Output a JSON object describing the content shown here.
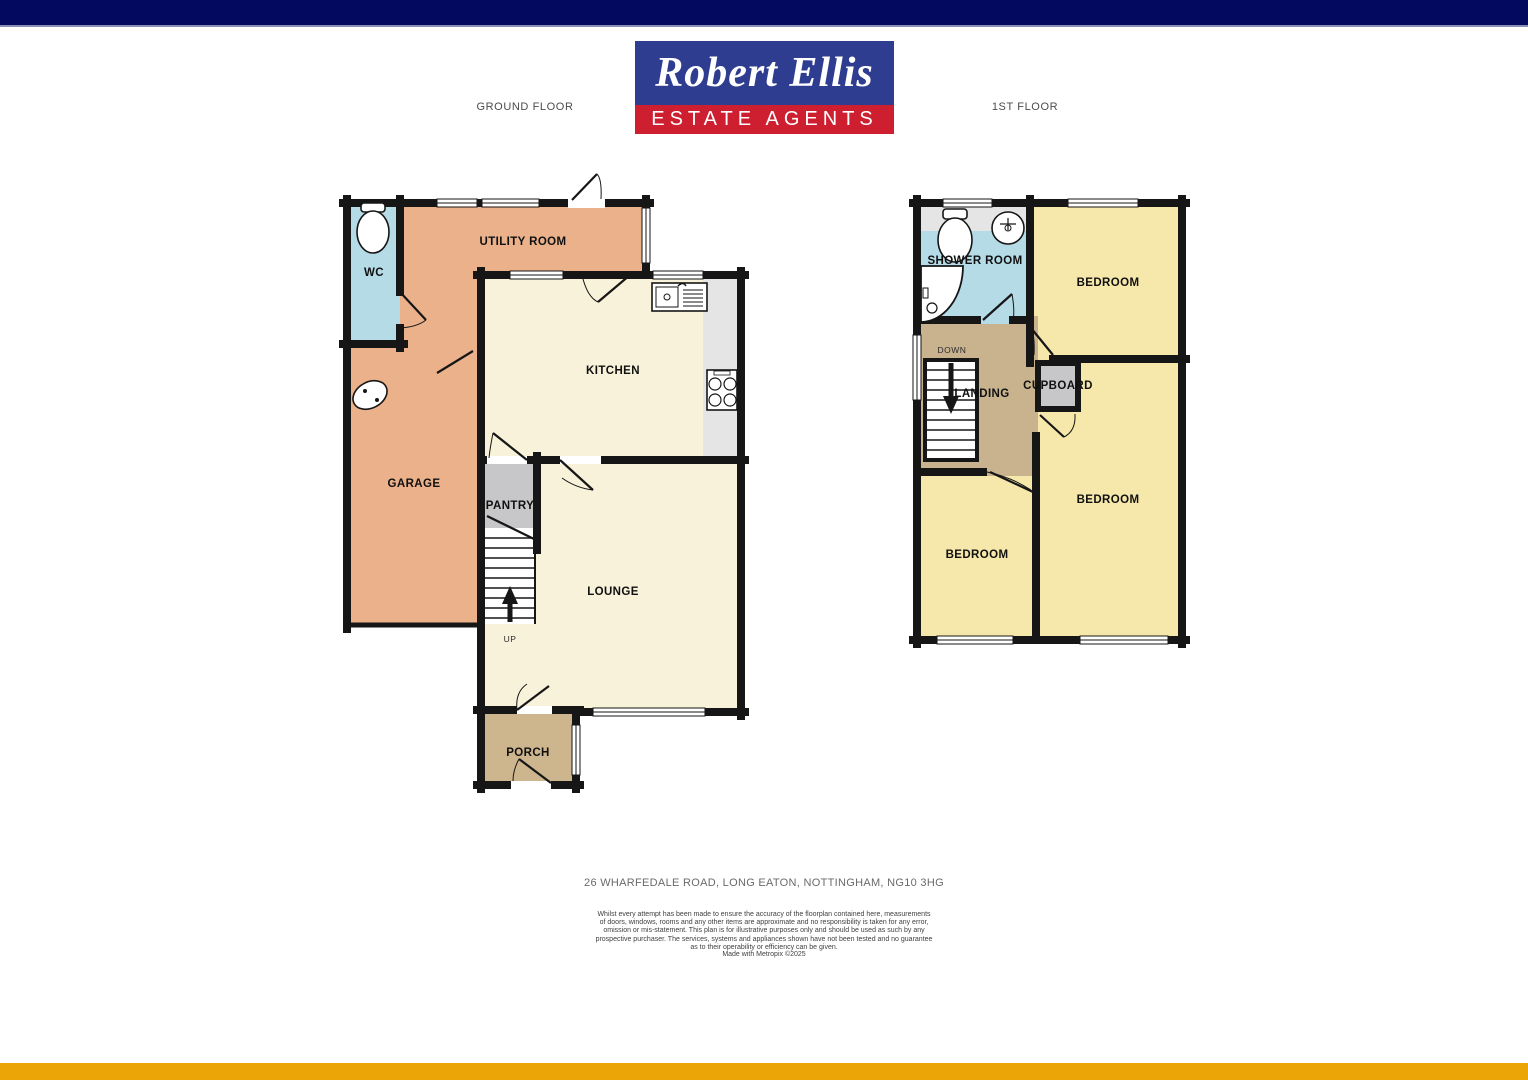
{
  "header": {
    "logo_line1": "Robert Ellis",
    "logo_line2": "ESTATE AGENTS",
    "ground_floor_label": "GROUND FLOOR",
    "first_floor_label": "1ST FLOOR"
  },
  "colors": {
    "top_bar": "#03095e",
    "bottom_bar": "#eba506",
    "logo_blue": "#2e3d90",
    "logo_red": "#ce1f30",
    "wall": "#161616",
    "room_orange": "#eab18b",
    "room_cream": "#f8f2da",
    "room_blue": "#b5dbe7",
    "room_yellow": "#f6e8ab",
    "room_tan_landing": "#c9b38e",
    "room_tan_porch": "#cdb58e",
    "room_gray": "#c7c7c9",
    "counter_gray": "#e5e5e5"
  },
  "ground_floor": {
    "rooms": {
      "wc": "WC",
      "utility": "UTILITY ROOM",
      "kitchen": "KITCHEN",
      "garage": "GARAGE",
      "pantry": "PANTRY",
      "lounge": "LOUNGE",
      "porch": "PORCH",
      "up": "UP"
    }
  },
  "first_floor": {
    "rooms": {
      "shower": "SHOWER ROOM",
      "bedroom_top": "BEDROOM",
      "down": "DOWN",
      "landing": "LANDING",
      "cupboard": "CUPBOARD",
      "bedroom_left": "BEDROOM",
      "bedroom_right": "BEDROOM"
    }
  },
  "footer": {
    "address": "26 WHARFEDALE ROAD, LONG EATON, NOTTINGHAM, NG10 3HG",
    "disclaimer": "Whilst every attempt has been made to ensure the accuracy of the floorplan contained here, measurements of doors, windows, rooms and any other items are approximate and no responsibility is taken for any error, omission or mis-statement. This plan is for illustrative purposes only and should be used as such by any prospective purchaser. The services, systems and appliances shown have not been tested and no guarantee as to their operability or efficiency can be given.",
    "credit": "Made with Metropix ©2025"
  }
}
